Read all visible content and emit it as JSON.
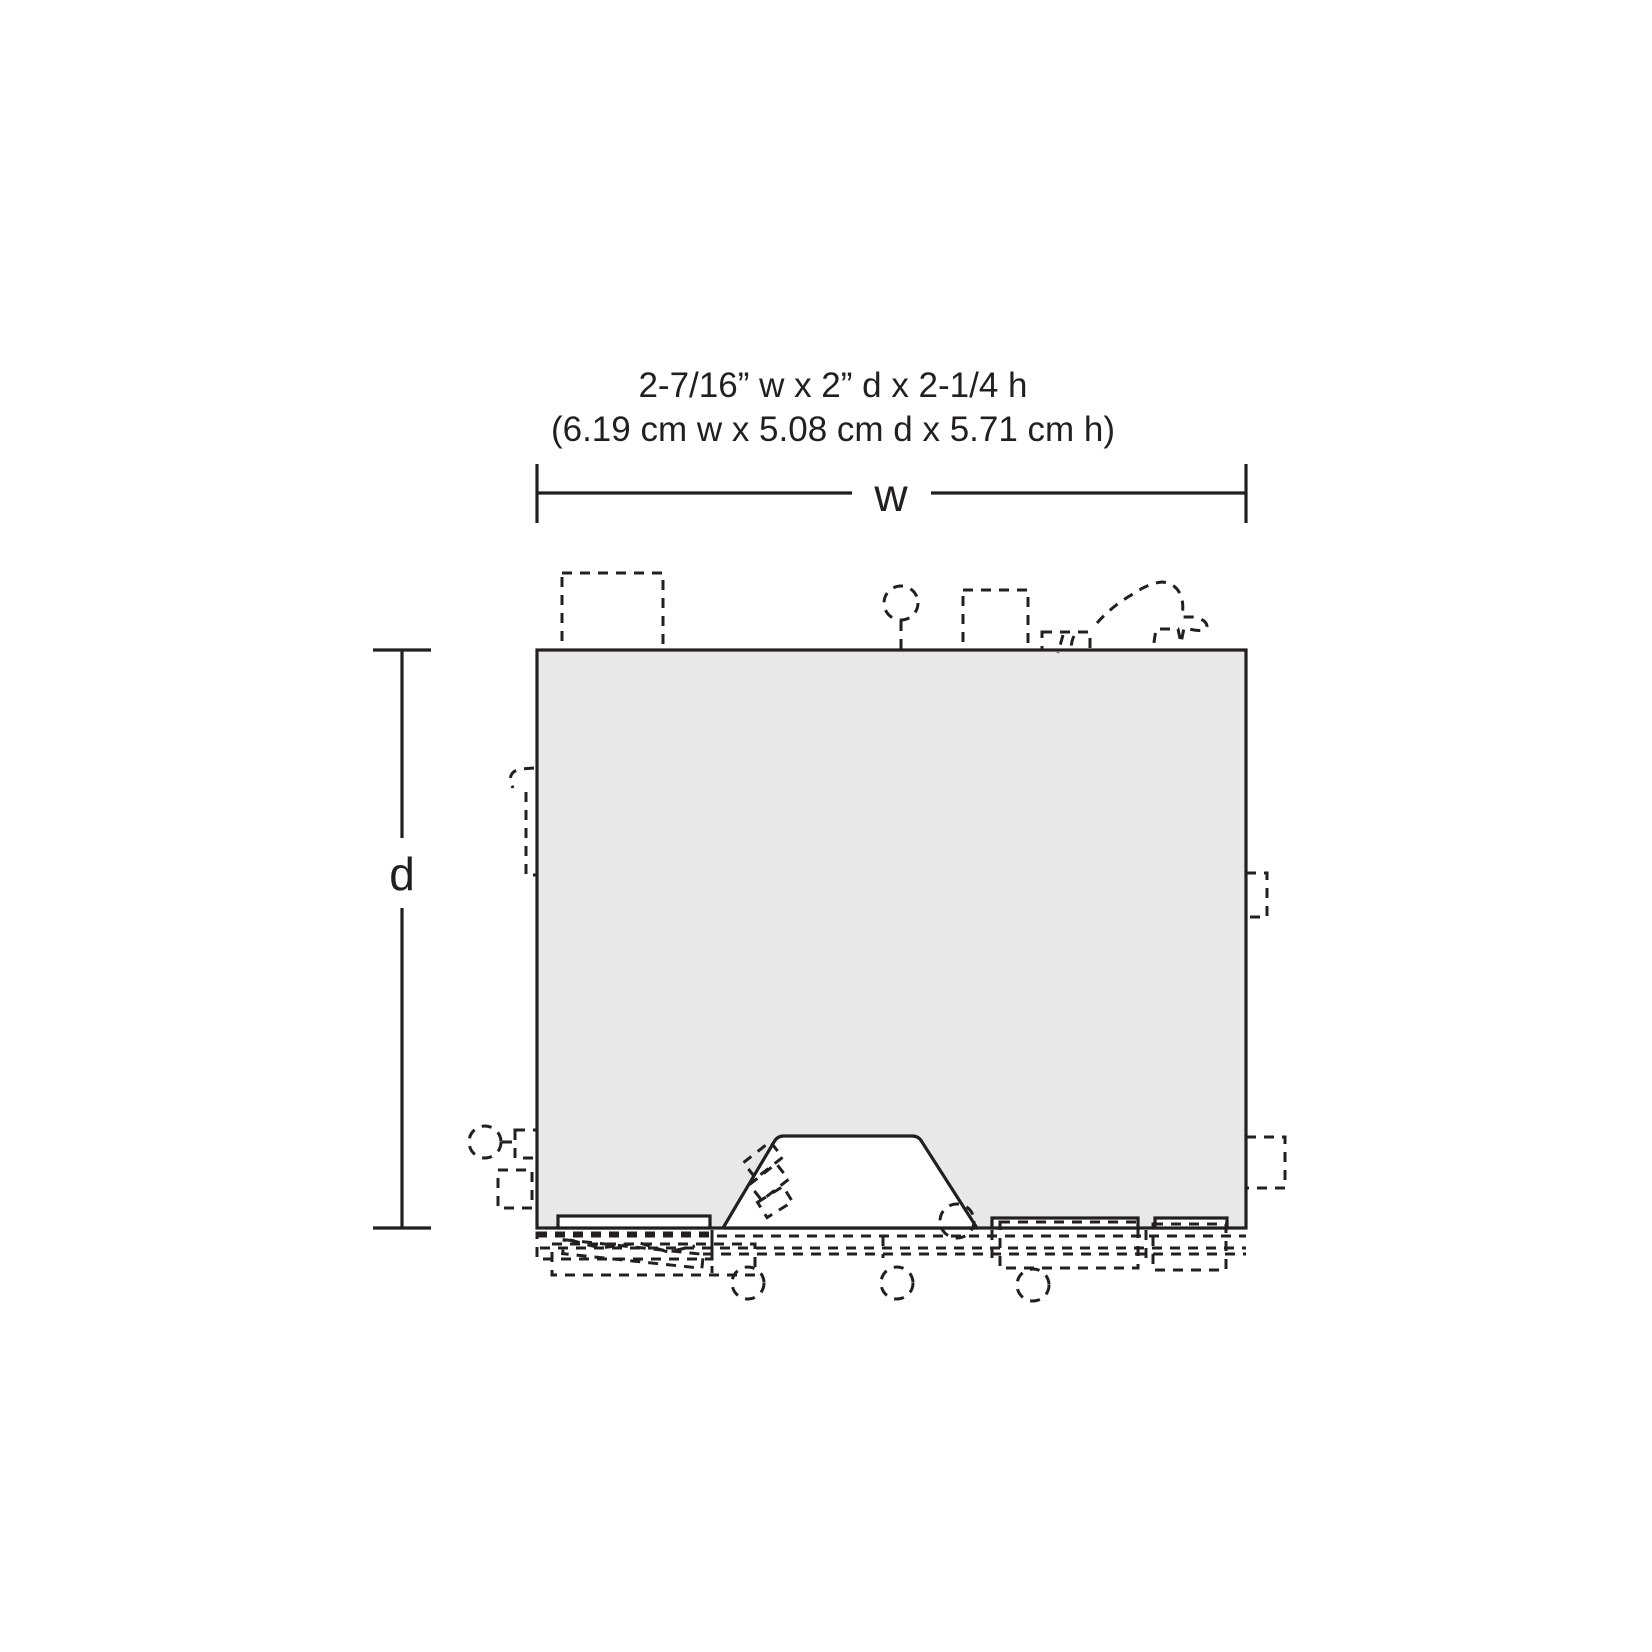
{
  "title": {
    "line1": "2-7/16” w x 2” d x 2-1/4 h",
    "line2": "(6.19 cm w x 5.08 cm d x 5.71 cm h)"
  },
  "dimensions": {
    "width_label": "w",
    "depth_label": "d"
  },
  "specs": {
    "width_imperial": "2-7/16”",
    "depth_imperial": "2”",
    "height_imperial": "2-1/4",
    "width_cm": "6.19",
    "depth_cm": "5.08",
    "height_cm": "5.71"
  },
  "colors": {
    "background": "#ffffff",
    "footprint_fill": "#e8e8e8",
    "cutout_fill": "#ffffff",
    "line": "#231f20"
  }
}
